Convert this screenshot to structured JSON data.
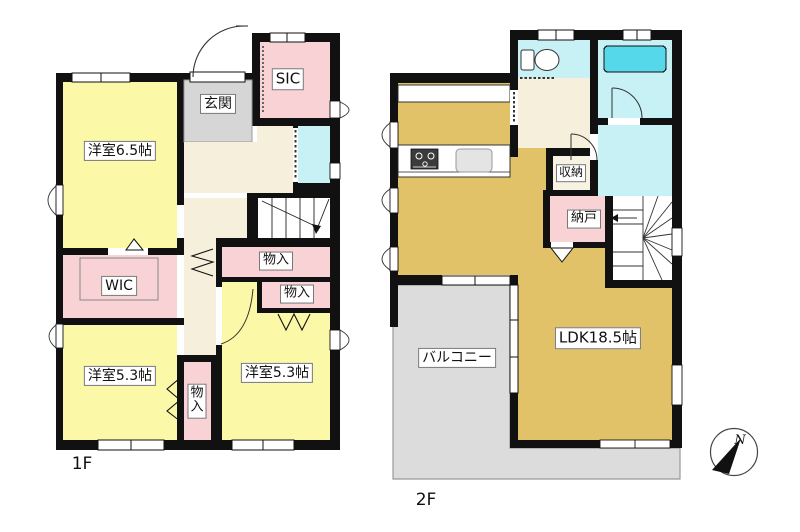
{
  "floors": {
    "f1": {
      "label": "1F",
      "rooms": {
        "bedroom65": {
          "label": "洋室6.5帖"
        },
        "genkan": {
          "label": "玄関"
        },
        "sic": {
          "label": "SIC"
        },
        "wic": {
          "label": "WIC"
        },
        "mono1": {
          "label": "物入"
        },
        "mono2": {
          "label": "物入"
        },
        "bedroom53l": {
          "label": "洋室5.3帖"
        },
        "bedroom53r": {
          "label": "洋室5.3帖"
        },
        "mono_v": {
          "label": "物入"
        }
      }
    },
    "f2": {
      "label": "2F",
      "rooms": {
        "shuno": {
          "label": "収納"
        },
        "nando": {
          "label": "納戸"
        },
        "ldk": {
          "label": "LDK18.5帖"
        },
        "balcony": {
          "label": "バルコニー"
        }
      }
    }
  },
  "compass": {
    "north": "N"
  },
  "colors": {
    "room_yellow": "#FBF8A8",
    "room_pink": "#F8D2D4",
    "entry_gray": "#D6D6D6",
    "hall_beige": "#F5EFDC",
    "water_cyan": "#C7F1F5",
    "tub_cyan": "#55D8EA",
    "ldk_tan": "#E2C269",
    "balcony_gray": "#DCDCDC",
    "wall": "#111111"
  }
}
